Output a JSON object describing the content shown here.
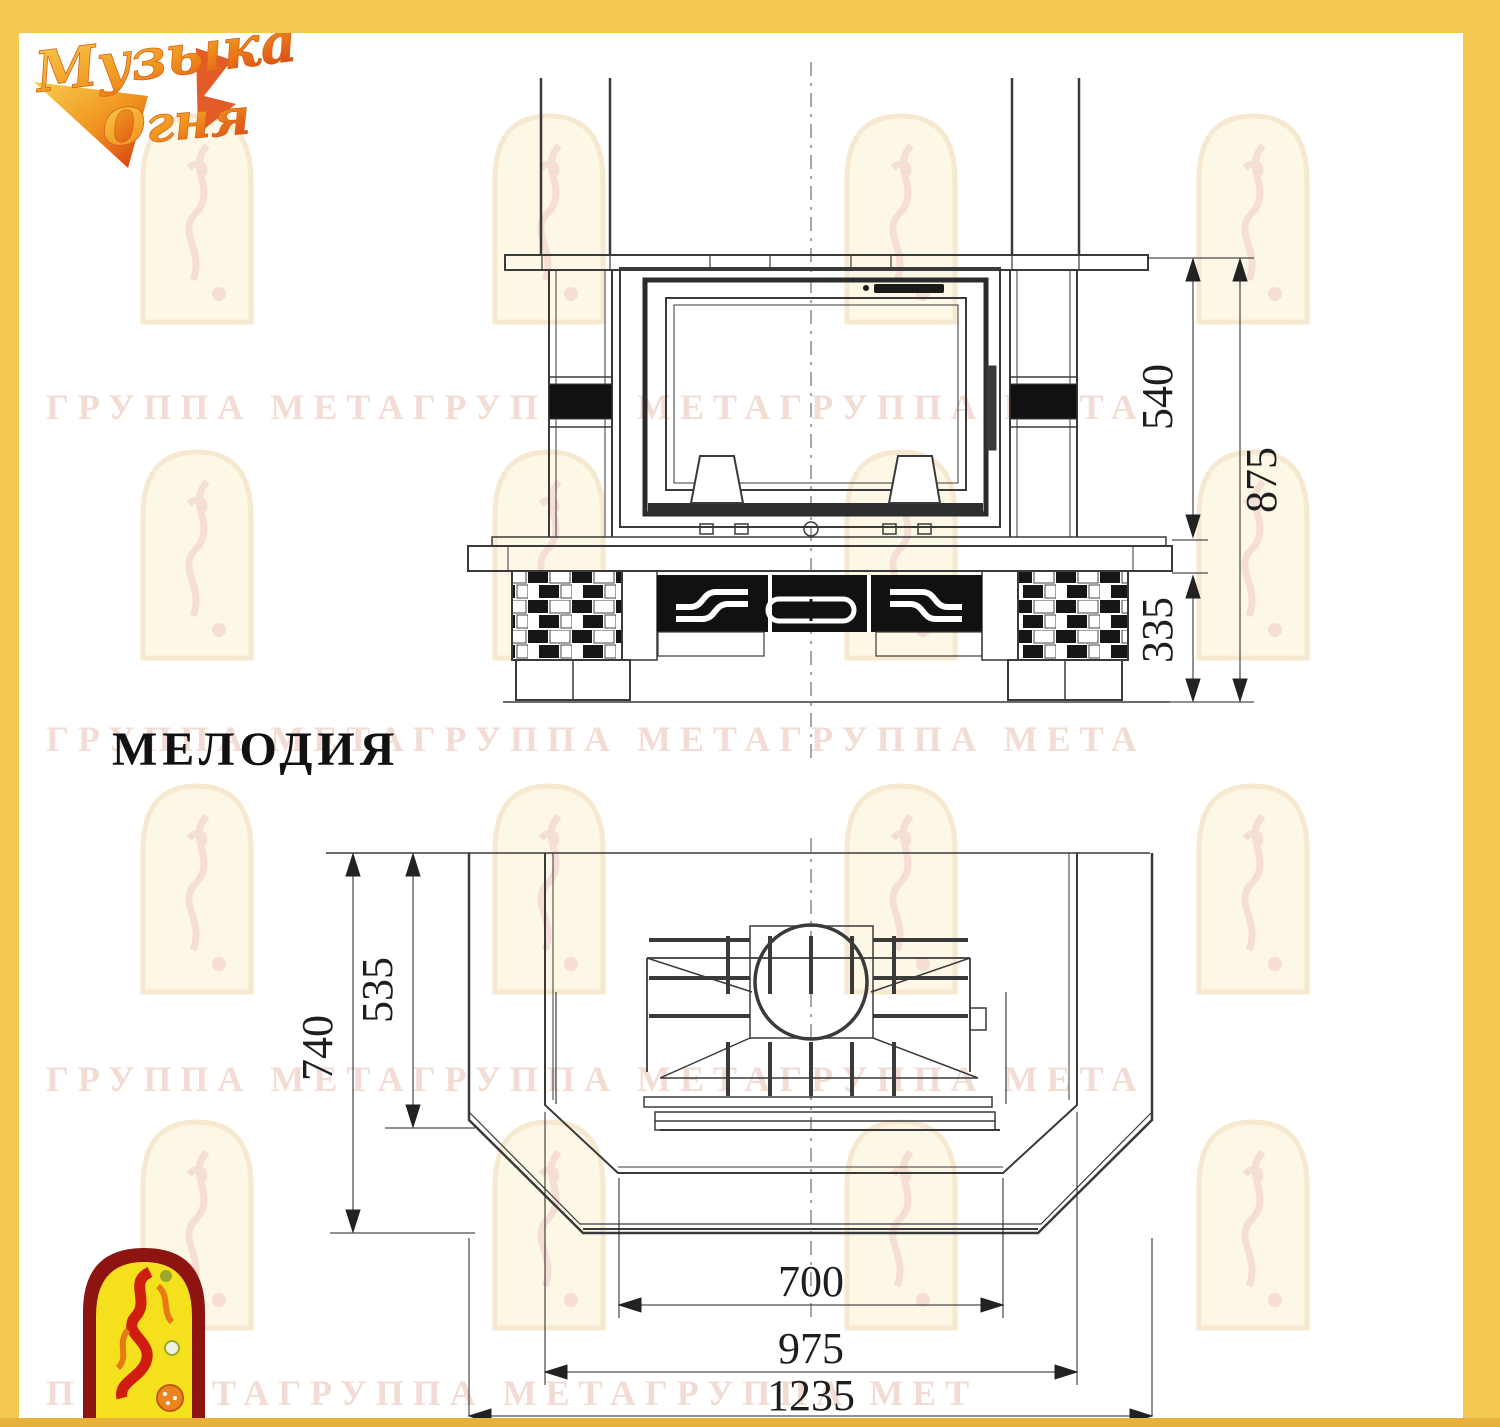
{
  "page": {
    "frame_color": "#f4c94f",
    "background": "#ffffff"
  },
  "brand_logo": {
    "line1": "Музыка",
    "line2": "Огня"
  },
  "watermark": {
    "row": "ГРУППА МЕТАГРУППА МЕТАГРУППА МЕТА",
    "row_partial": "ПА МЕТАГРУППА МЕТАГРУППА МЕТ"
  },
  "model_title": "МЕЛОДИЯ",
  "front_view": {
    "dim_firebox_height": "540",
    "dim_total_height": "875",
    "dim_base_height": "335"
  },
  "plan_view": {
    "dim_depth_total": "740",
    "dim_depth_firebox": "535",
    "dim_width_firebox": "700",
    "dim_width_base": "975",
    "dim_width_total": "1235"
  }
}
